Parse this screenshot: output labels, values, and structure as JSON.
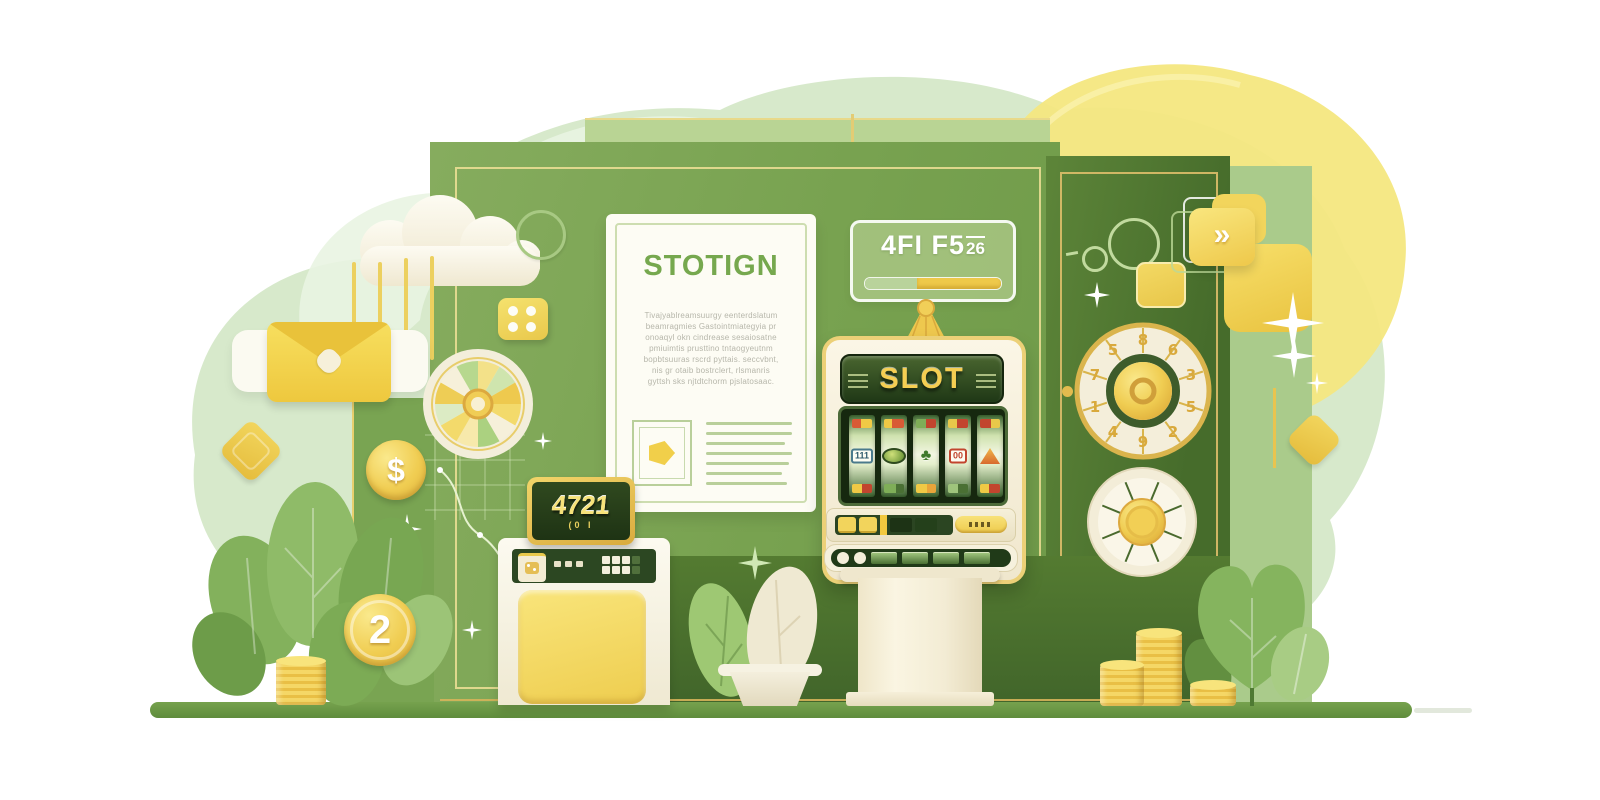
{
  "scene": {
    "theme": "green and gold casino slot-machine illustration"
  },
  "colors": {
    "accent_green": "#7da356",
    "dark_green": "#44682a",
    "gold": "#e9c44f",
    "cream": "#f6f0dc",
    "mint_blob": "#d7e9cb",
    "yellow_blob": "#f4e77f",
    "ground": "#6a9a46"
  },
  "document_card": {
    "title": "STOTIGN",
    "paragraph_lines": [
      "Tivajyablreamsuurgy eenterdslatum",
      "beamragmies Gastointmiategyia pr",
      "onoaqyl okn cindrease sesaiosatne",
      "pmiuimtis prusttino tntaogyeutnm",
      "bopbtsuuras rscrd pyttais. seccvbnt,",
      "nis gr otaib bostrclert, rlsmanris",
      "gyttsh sks njtdtchorm pjslatosaac."
    ]
  },
  "sign": {
    "text_main": "4FI F5",
    "text_small": "26",
    "progress_pct": 38
  },
  "slot_machine": {
    "banner_text": "SLOT",
    "reel_symbols": [
      "111",
      "",
      "♣",
      "00",
      ""
    ],
    "reel_icons": [
      "badge-111",
      "green-oval",
      "clover",
      "badge-00",
      "orange-peak"
    ]
  },
  "kiosk": {
    "display_main": "4721",
    "display_sub": "(0 I"
  },
  "dial": {
    "digits": [
      "8",
      "6",
      "3",
      "5",
      "2",
      "9",
      "4",
      "1",
      "7",
      "5"
    ]
  },
  "coins": {
    "dollar_symbol": "$",
    "two_label": "2"
  },
  "top_right": {
    "arrow_glyph": "»"
  }
}
